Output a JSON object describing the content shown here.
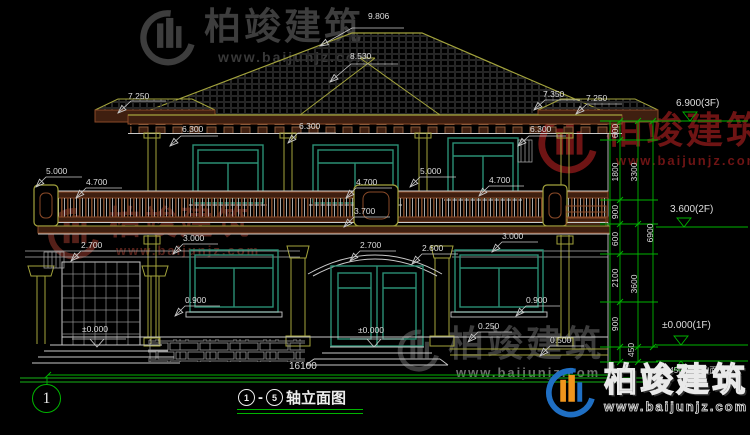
{
  "watermarks": {
    "brand": "柏竣建筑",
    "url": "www.baijunjz.com"
  },
  "title": {
    "axis_start": "1",
    "axis_end": "5",
    "dash": "-",
    "label": "轴立面图"
  },
  "axis_bubble": {
    "number": "1"
  },
  "total_width_dim": "16100",
  "colors": {
    "cad_green": "#00b400",
    "olive": "#a3a33c",
    "teal": "#2a8f74",
    "brown": "#8a4a28",
    "brand_blue": "#1f6fc4",
    "brand_orange": "#f0951c"
  },
  "levels": [
    {
      "label": "6.900(3F)"
    },
    {
      "label": "3.600(2F)"
    },
    {
      "label": "±0.000(1F)"
    },
    {
      "label": "-0.450(室外地面)"
    }
  ],
  "dims": [
    {
      "t": "9.806",
      "x": 368,
      "y": 12
    },
    {
      "t": "8.530",
      "x": 350,
      "y": 52
    },
    {
      "t": "7.250",
      "x": 128,
      "y": 92
    },
    {
      "t": "6.300",
      "x": 182,
      "y": 125
    },
    {
      "t": "6.300",
      "x": 299,
      "y": 122
    },
    {
      "t": "6.300",
      "x": 530,
      "y": 125
    },
    {
      "t": "7.350",
      "x": 543,
      "y": 90
    },
    {
      "t": "7.250",
      "x": 586,
      "y": 94
    },
    {
      "t": "5.000",
      "x": 46,
      "y": 167
    },
    {
      "t": "4.700",
      "x": 86,
      "y": 178
    },
    {
      "t": "5.000",
      "x": 420,
      "y": 167
    },
    {
      "t": "4.700",
      "x": 356,
      "y": 178
    },
    {
      "t": "4.700",
      "x": 489,
      "y": 176
    },
    {
      "t": "3.700",
      "x": 354,
      "y": 207
    },
    {
      "t": "2.700",
      "x": 81,
      "y": 241
    },
    {
      "t": "3.000",
      "x": 183,
      "y": 234
    },
    {
      "t": "2.700",
      "x": 360,
      "y": 241
    },
    {
      "t": "2.600",
      "x": 422,
      "y": 244
    },
    {
      "t": "3.000",
      "x": 502,
      "y": 232
    },
    {
      "t": "0.900",
      "x": 185,
      "y": 296
    },
    {
      "t": "0.900",
      "x": 526,
      "y": 296
    },
    {
      "t": "0.250",
      "x": 478,
      "y": 322
    },
    {
      "t": "0.500",
      "x": 550,
      "y": 336
    },
    {
      "t": "±0.000",
      "x": 358,
      "y": 326
    },
    {
      "t": "±0.000",
      "x": 82,
      "y": 325
    },
    {
      "t": "16100",
      "x": 289,
      "y": 362,
      "fs": 10
    },
    {
      "t": "6.900(3F)",
      "x": 676,
      "y": 99,
      "fs": 10
    },
    {
      "t": "3.600(2F)",
      "x": 670,
      "y": 205,
      "fs": 10
    },
    {
      "t": "±0.000(1F)",
      "x": 662,
      "y": 321,
      "fs": 10
    },
    {
      "t": "-0.450(室外地面)",
      "x": 660,
      "y": 367,
      "fs": 8
    },
    {
      "t": "600",
      "x": 615,
      "y": 131,
      "rot": 1
    },
    {
      "t": "1800",
      "x": 615,
      "y": 172,
      "rot": 1
    },
    {
      "t": "900",
      "x": 615,
      "y": 212,
      "rot": 1
    },
    {
      "t": "600",
      "x": 615,
      "y": 239,
      "rot": 1
    },
    {
      "t": "2100",
      "x": 615,
      "y": 278,
      "rot": 1
    },
    {
      "t": "900",
      "x": 615,
      "y": 324,
      "rot": 1
    },
    {
      "t": "450",
      "x": 631,
      "y": 350,
      "rot": 1
    },
    {
      "t": "3300",
      "x": 634,
      "y": 172,
      "rot": 1
    },
    {
      "t": "3600",
      "x": 634,
      "y": 284,
      "rot": 1
    },
    {
      "t": "6900",
      "x": 650,
      "y": 233,
      "rot": 1
    }
  ]
}
